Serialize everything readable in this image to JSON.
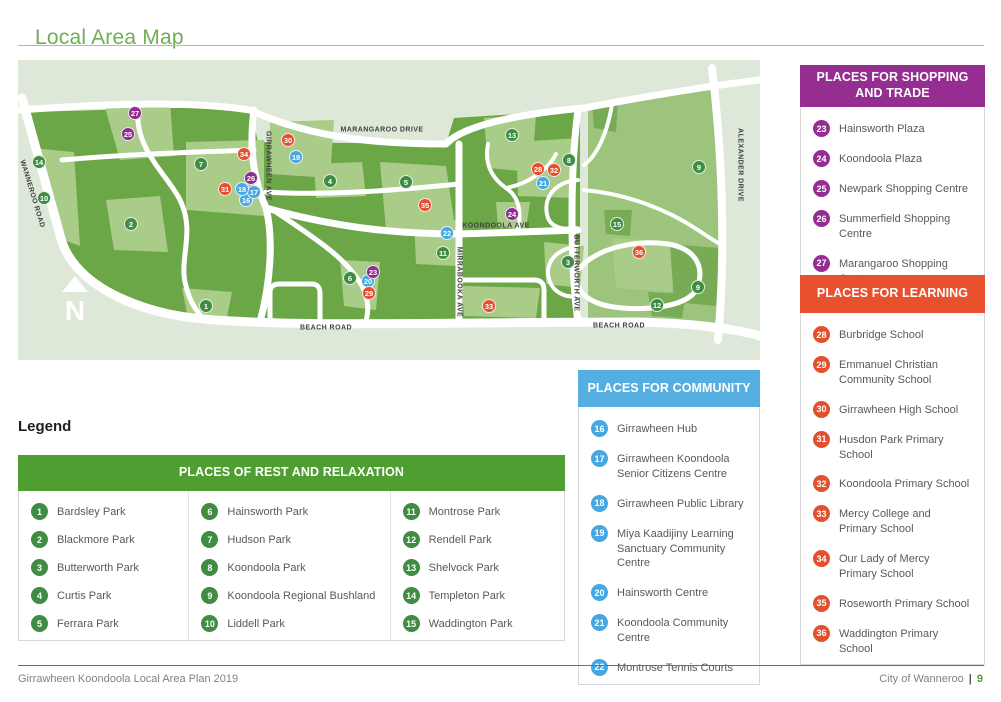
{
  "page": {
    "title": "Local Area Map",
    "footer_left": "Girrawheen Koondoola Local Area Plan 2019",
    "footer_right": "City of Wanneroo",
    "footer_sep": "|",
    "footer_page": "9"
  },
  "colors": {
    "title_green": "#6fae51",
    "legend_header_green": "#4f9e31",
    "community_blue": "#55aee0",
    "shopping_purple": "#962d91",
    "learning_orange": "#e8512d",
    "marker_green": "#3f8c42",
    "marker_blue": "#47a7e0",
    "marker_purple": "#8f2b8d",
    "marker_red": "#e4502e",
    "text_grey": "#58595b"
  },
  "map": {
    "compass_label": "N",
    "road_labels": [
      {
        "text": "MARANGAROO DRIVE",
        "x": 364,
        "y": 70,
        "rotate": 0
      },
      {
        "text": "WANNEROO ROAD",
        "x": 14,
        "y": 134,
        "rotate": 73
      },
      {
        "text": "GIRRAWHEEN AVE",
        "x": 250,
        "y": 106,
        "rotate": 90
      },
      {
        "text": "KOONDOOLA AVE",
        "x": 478,
        "y": 166,
        "rotate": 0
      },
      {
        "text": "MIRRABOOKA AVE",
        "x": 441,
        "y": 222,
        "rotate": 90
      },
      {
        "text": "BUTTERWORTH AVE",
        "x": 558,
        "y": 213,
        "rotate": 90
      },
      {
        "text": "ALEXANDER DRIVE",
        "x": 722,
        "y": 105,
        "rotate": 90
      },
      {
        "text": "BEACH ROAD",
        "x": 308,
        "y": 268,
        "rotate": 0
      },
      {
        "text": "BEACH ROAD",
        "x": 601,
        "y": 266,
        "rotate": 0
      }
    ],
    "markers": [
      {
        "n": 1,
        "x": 188,
        "y": 246
      },
      {
        "n": 2,
        "x": 113,
        "y": 164
      },
      {
        "n": 3,
        "x": 550,
        "y": 202
      },
      {
        "n": 4,
        "x": 312,
        "y": 121
      },
      {
        "n": 5,
        "x": 388,
        "y": 122
      },
      {
        "n": 6,
        "x": 332,
        "y": 218
      },
      {
        "n": 7,
        "x": 183,
        "y": 104
      },
      {
        "n": 8,
        "x": 551,
        "y": 100
      },
      {
        "n": 9,
        "x": 681,
        "y": 107
      },
      {
        "n": 9,
        "x": 680,
        "y": 227
      },
      {
        "n": 10,
        "x": 26,
        "y": 138
      },
      {
        "n": 11,
        "x": 425,
        "y": 193
      },
      {
        "n": 12,
        "x": 639,
        "y": 245
      },
      {
        "n": 13,
        "x": 494,
        "y": 75
      },
      {
        "n": 14,
        "x": 21,
        "y": 102
      },
      {
        "n": 15,
        "x": 599,
        "y": 164
      },
      {
        "n": 16,
        "x": 228,
        "y": 140
      },
      {
        "n": 17,
        "x": 236,
        "y": 132
      },
      {
        "n": 18,
        "x": 224,
        "y": 129
      },
      {
        "n": 19,
        "x": 278,
        "y": 97
      },
      {
        "n": 20,
        "x": 350,
        "y": 221
      },
      {
        "n": 21,
        "x": 525,
        "y": 123
      },
      {
        "n": 22,
        "x": 429,
        "y": 173
      },
      {
        "n": 23,
        "x": 355,
        "y": 212
      },
      {
        "n": 24,
        "x": 494,
        "y": 154
      },
      {
        "n": 25,
        "x": 110,
        "y": 74
      },
      {
        "n": 26,
        "x": 233,
        "y": 118
      },
      {
        "n": 27,
        "x": 117,
        "y": 53
      },
      {
        "n": 28,
        "x": 520,
        "y": 109
      },
      {
        "n": 29,
        "x": 351,
        "y": 233
      },
      {
        "n": 30,
        "x": 270,
        "y": 80
      },
      {
        "n": 31,
        "x": 207,
        "y": 129
      },
      {
        "n": 32,
        "x": 536,
        "y": 110
      },
      {
        "n": 33,
        "x": 471,
        "y": 246
      },
      {
        "n": 34,
        "x": 226,
        "y": 94
      },
      {
        "n": 35,
        "x": 407,
        "y": 145
      },
      {
        "n": 36,
        "x": 621,
        "y": 192
      }
    ]
  },
  "legend": {
    "heading": "Legend",
    "rest": {
      "title": "PLACES OF REST AND RELAXATION",
      "columns": [
        [
          {
            "n": 1,
            "label": "Bardsley Park"
          },
          {
            "n": 2,
            "label": "Blackmore Park"
          },
          {
            "n": 3,
            "label": "Butterworth Park"
          },
          {
            "n": 4,
            "label": "Curtis Park"
          },
          {
            "n": 5,
            "label": "Ferrara Park"
          }
        ],
        [
          {
            "n": 6,
            "label": "Hainsworth Park"
          },
          {
            "n": 7,
            "label": "Hudson Park"
          },
          {
            "n": 8,
            "label": "Koondoola Park"
          },
          {
            "n": 9,
            "label": "Koondoola Regional Bushland"
          },
          {
            "n": 10,
            "label": "Liddell Park"
          }
        ],
        [
          {
            "n": 11,
            "label": "Montrose Park"
          },
          {
            "n": 12,
            "label": "Rendell Park"
          },
          {
            "n": 13,
            "label": "Shelvock Park"
          },
          {
            "n": 14,
            "label": "Templeton Park"
          },
          {
            "n": 15,
            "label": "Waddington Park"
          }
        ]
      ]
    },
    "community": {
      "title": "PLACES FOR COMMUNITY",
      "items": [
        {
          "n": 16,
          "label": "Girrawheen Hub"
        },
        {
          "n": 17,
          "label": "Girrawheen Koondoola\nSenior Citizens Centre"
        },
        {
          "n": 18,
          "label": "Girrawheen Public Library"
        },
        {
          "n": 19,
          "label": "Miya Kaadijiny Learning\nSanctuary Community Centre"
        },
        {
          "n": 20,
          "label": "Hainsworth Centre"
        },
        {
          "n": 21,
          "label": "Koondoola Community Centre"
        },
        {
          "n": 22,
          "label": "Montrose Tennis Courts"
        }
      ]
    },
    "shopping": {
      "title": "PLACES FOR SHOPPING\nAND TRADE",
      "items": [
        {
          "n": 23,
          "label": "Hainsworth Plaza"
        },
        {
          "n": 24,
          "label": "Koondoola Plaza"
        },
        {
          "n": 25,
          "label": "Newpark Shopping Centre"
        },
        {
          "n": 26,
          "label": "Summerfield Shopping Centre"
        },
        {
          "n": 27,
          "label": "Marangaroo Shopping Centre"
        }
      ]
    },
    "learning": {
      "title": "PLACES FOR LEARNING",
      "items": [
        {
          "n": 28,
          "label": "Burbridge School"
        },
        {
          "n": 29,
          "label": "Emmanuel Christian\nCommunity School"
        },
        {
          "n": 30,
          "label": "Girrawheen High School"
        },
        {
          "n": 31,
          "label": "Husdon Park Primary School"
        },
        {
          "n": 32,
          "label": "Koondoola Primary School"
        },
        {
          "n": 33,
          "label": "Mercy College and\nPrimary School"
        },
        {
          "n": 34,
          "label": "Our Lady of Mercy\nPrimary School"
        },
        {
          "n": 35,
          "label": "Roseworth Primary School"
        },
        {
          "n": 36,
          "label": "Waddington Primary School"
        }
      ]
    }
  }
}
